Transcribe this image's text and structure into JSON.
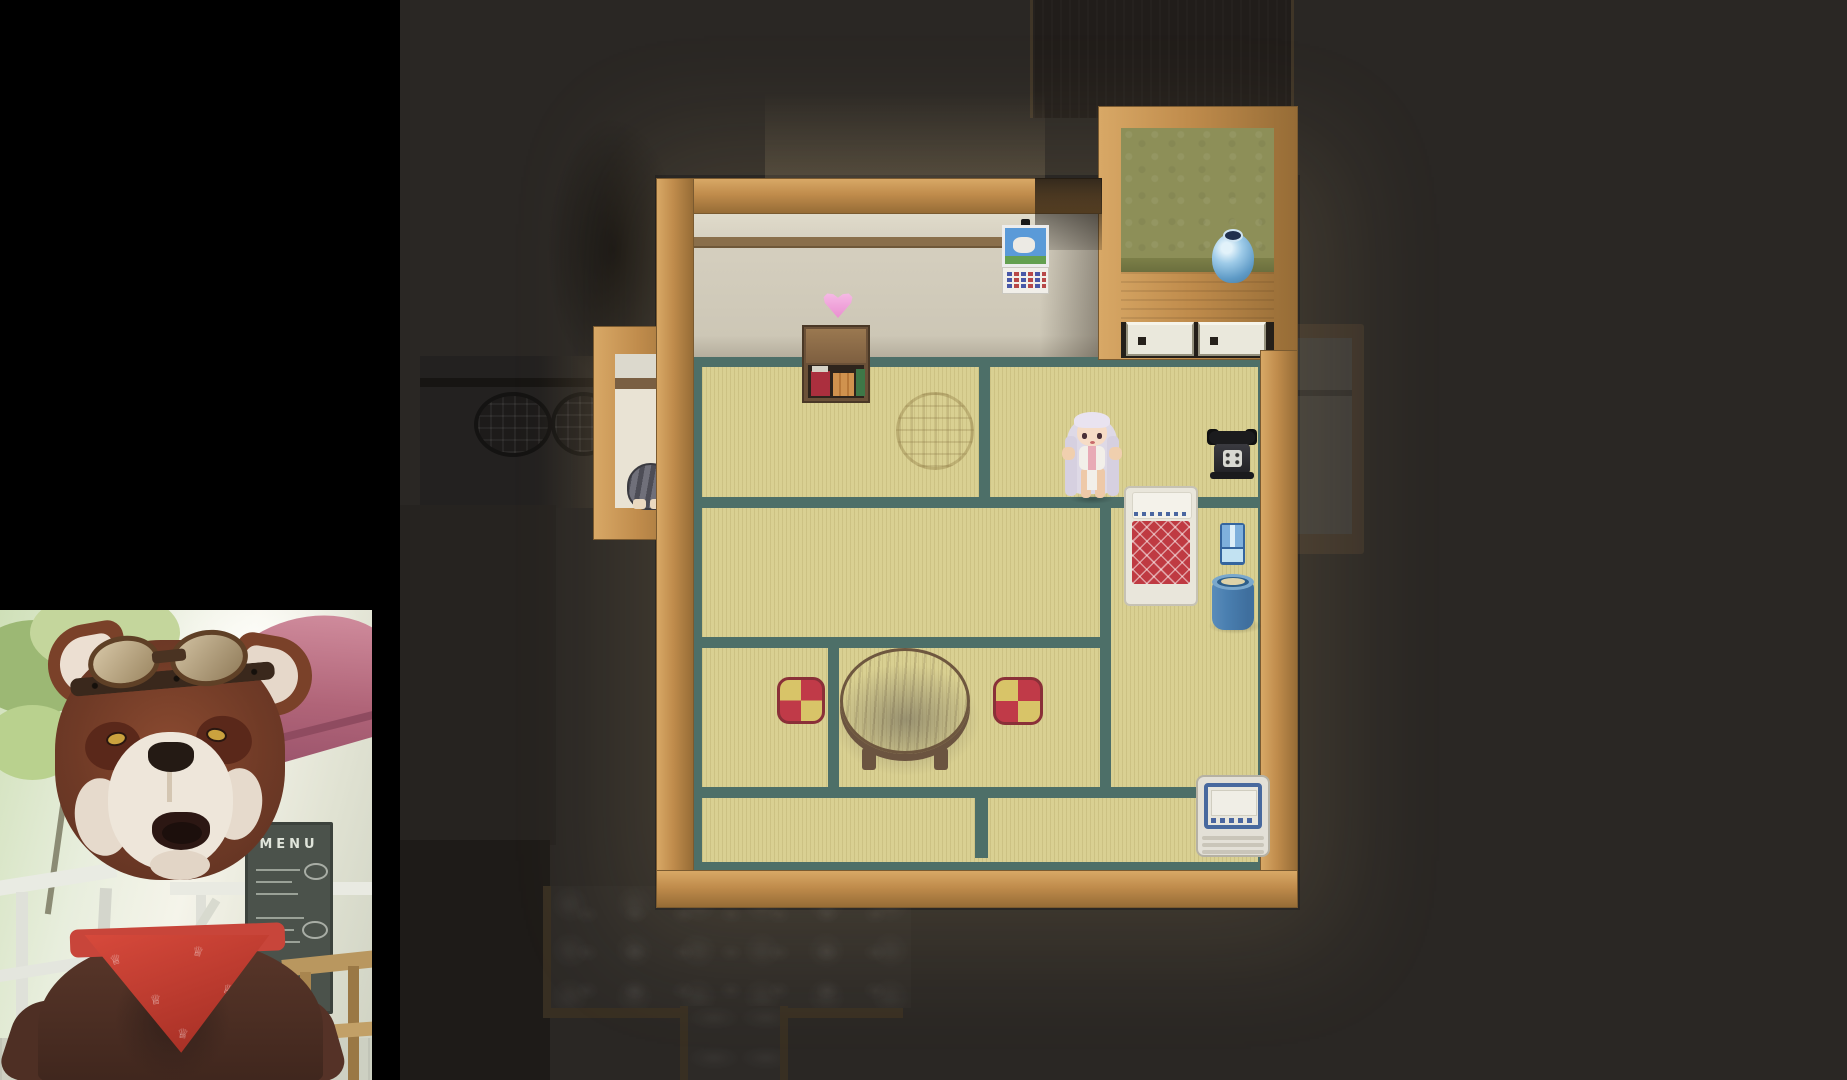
{
  "scene": {
    "type": "game-screenshot",
    "style": "top-down pixel RPG (RPG Maker style) with streamer facecam overlay",
    "location": "japanese-tatami-room"
  },
  "webcam": {
    "subject": "red-panda-character-with-goggles-and-bandana",
    "menu_board": {
      "title": "MENU"
    },
    "bandana": {
      "glyph": "♕"
    }
  },
  "game": {
    "player": "white-haired-girl-sprite",
    "objects": [
      "bookshelf",
      "heart-indicator",
      "calendar",
      "blue-vase",
      "drawers",
      "rotary-phone",
      "futon-bed",
      "water-jug",
      "bucket",
      "round-table",
      "floor-cushion",
      "floor-cushion",
      "washing-machine",
      "sleeping-cat",
      "round-straw-mat",
      "stone-path",
      "dim-round-windows"
    ],
    "colors": {
      "tatami": "#d9d092",
      "tatami_border": "#4d6f68",
      "wood_frame": "#c08c4c",
      "wall": "#d0cab9",
      "alcove_wall": "#8d8f58",
      "futon_red": "#bf3a42",
      "heart_pink": "#ea8fd0",
      "bandana_red": "#c33b2f",
      "background_dark": "#2a2724"
    }
  }
}
